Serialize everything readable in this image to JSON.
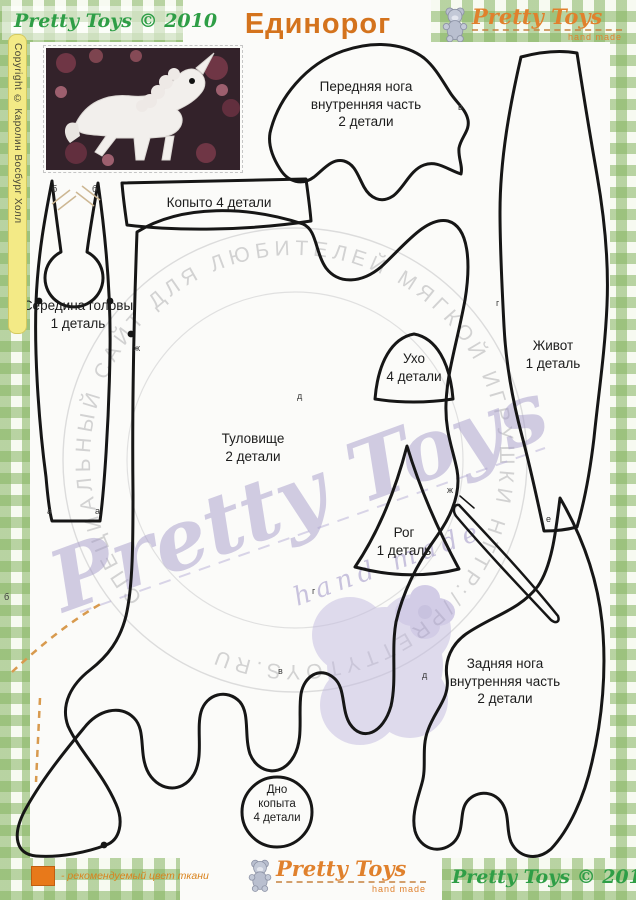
{
  "page": {
    "title": "Единорог"
  },
  "branding": {
    "logo_top_left": "Pretty Toys © 2010",
    "logo_top_right": {
      "brand": "Pretty Toys",
      "tagline": "hand made"
    },
    "logo_bottom_center": {
      "brand": "Pretty Toys",
      "tagline": "hand made"
    },
    "logo_bottom_right": "Pretty Toys © 2010"
  },
  "sidebar": {
    "copyright": "Copyright © Каролин Восбург Холл"
  },
  "watermarks": {
    "circle_text": "СПЕЦИАЛЬНЫЙ САЙТ ДЛЯ ЛЮБИТЕЛЕЙ МЯГКОЙ ИГРУШКИ НТТР://PRETTYTOYS.RU",
    "script": "Pretty Toys",
    "handmade": "hand made"
  },
  "pieces": {
    "front_leg": {
      "label": "Передняя нога\nвнутренняя часть\n2 детали"
    },
    "hoof": {
      "label": "Копыто 4 детали"
    },
    "head_center": {
      "label": "Середина головы\n1 деталь"
    },
    "belly": {
      "label": "Живот\n1 деталь"
    },
    "ear": {
      "label": "Ухо\n4 детали"
    },
    "body": {
      "label": "Туловище\n2 детали"
    },
    "horn": {
      "label": "Рог\n1 деталь"
    },
    "back_leg": {
      "label": "Задняя нога\nвнутренняя часть\n2 детали"
    },
    "hoof_bottom": {
      "label": "Дно\nкопыта\n4 детали"
    }
  },
  "markers": [
    "б",
    "б",
    "а",
    "а",
    "ж",
    "ж",
    "в",
    "в",
    "г",
    "г",
    "д",
    "д",
    "б",
    "е"
  ],
  "legend": {
    "text": "- рекомендуемый цвет ткани"
  },
  "colors": {
    "title_orange": "#d4731d",
    "logo_green": "#2e9e46",
    "brand_orange": "#e0812d",
    "gingham_green": "#a9cd8a",
    "watermark_lavender": "#a79dcb",
    "legend_orange": "#e8791a"
  }
}
